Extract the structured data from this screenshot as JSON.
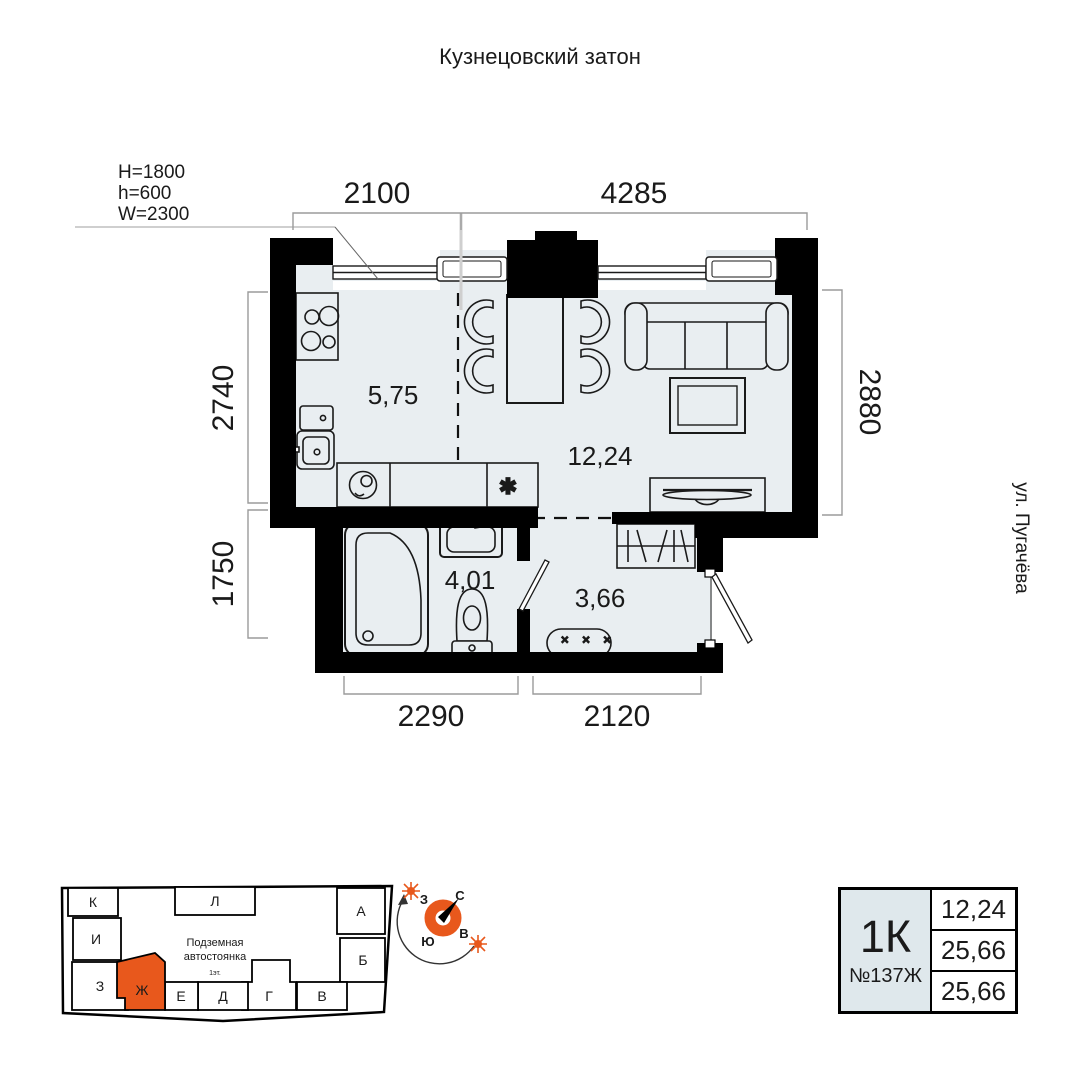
{
  "header": {
    "title": "Кузнецовский затон"
  },
  "side_label": "ул. Пугачёва",
  "window_spec": {
    "line1": "H=1800",
    "line2": "h=600",
    "line3": "W=2300"
  },
  "dims": {
    "top_left": "2100",
    "top_right": "4285",
    "left_upper": "2740",
    "left_lower": "1750",
    "right": "2880",
    "bottom_left": "2290",
    "bottom_right": "2120"
  },
  "rooms": {
    "kitchen": "5,75",
    "living": "12,24",
    "bathroom": "4,01",
    "hall": "3,66"
  },
  "symbols": {
    "dishwasher": "✱",
    "shoe_bench": "× × ×"
  },
  "compass": {
    "n": "С",
    "s": "Ю",
    "w": "З",
    "e": "В"
  },
  "site_plan": {
    "center_line1": "Подземная",
    "center_line2": "автостоянка",
    "floor_note": "1эт.",
    "buildings": {
      "k": "К",
      "i": "И",
      "z": "З",
      "zh": "Ж",
      "l": "Л",
      "a": "А",
      "b": "Б",
      "v": "В",
      "g": "Г",
      "d": "Д",
      "e": "Е"
    },
    "highlighted": "Ж"
  },
  "info_card": {
    "type": "1К",
    "number": "№137Ж",
    "area_living": "12,24",
    "area_total": "25,66",
    "area_full": "25,66"
  },
  "colors": {
    "accent": "#E8581C",
    "floor": "#E9EEF1",
    "wall": "#000000",
    "dim_line": "#9B9B9B"
  }
}
